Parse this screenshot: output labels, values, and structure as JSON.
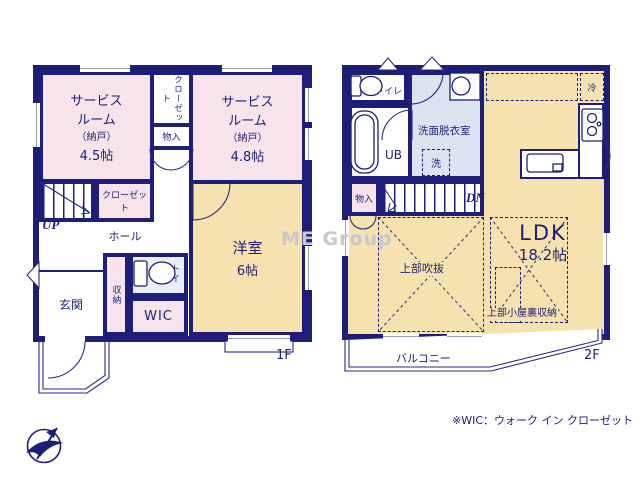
{
  "palette": {
    "wall": "#1e1e78",
    "pink": "#f7e3e9",
    "tan": "#f5e2ae",
    "blue": "#dce4f2",
    "ltblue": "#eaeef7",
    "winline": "#9aa0b8",
    "watermark": "#c7c8d2"
  },
  "watermark": "ME Group",
  "note": "※WIC：ウォーク イン クローゼット",
  "f1": {
    "label": "1F",
    "svc45": {
      "n1": "サービス",
      "n2": "ルーム",
      "sub": "（納戸）",
      "size": "4.5帖"
    },
    "svc48": {
      "n1": "サービス",
      "n2": "ルーム",
      "sub": "（納戸）",
      "size": "4.8帖"
    },
    "closet_top": "クローゼット",
    "mono": "物入",
    "closet2": "クローゼット",
    "up": "UP",
    "hall": "ホール",
    "genkan": "玄関",
    "shuno": "収納",
    "toilet": "トイレ",
    "wic": "WIC",
    "yo": {
      "n": "洋室",
      "size": "6帖"
    }
  },
  "f2": {
    "label": "2F",
    "toilet": "トイレ",
    "ub": "UB",
    "wash": "洗面脱衣室",
    "laundry": "洗",
    "fridge": "冷",
    "mono": "物入",
    "dn": "DN",
    "ldk": {
      "n": "LDK",
      "size": "18.2帖"
    },
    "void": "上部吹抜",
    "attic": "上部小屋裏収納",
    "balcony": "バルコニー"
  }
}
